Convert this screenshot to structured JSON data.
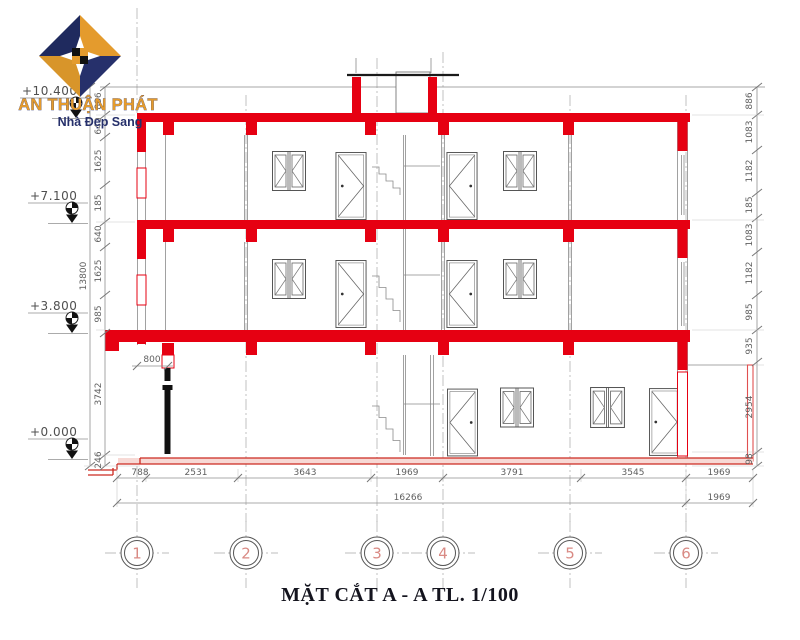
{
  "logo": {
    "company": "AN THUẬN PHÁT",
    "tagline": "Nhà Đẹp Sang"
  },
  "title": "MẶT CẮT A - A TL. 1/100",
  "elevations": {
    "roof": "+10.400",
    "floor3": "+7.100",
    "floor2": "+3.800",
    "ground": "+0.000"
  },
  "dimensions": {
    "left_overall": "13800",
    "left_chain": [
      "886",
      "640",
      "1625",
      "185",
      "640",
      "1625",
      "985",
      "3742",
      "246"
    ],
    "right_chain": [
      "886",
      "1083",
      "1182",
      "185",
      "1083",
      "1182",
      "985",
      "935",
      "2954",
      "98"
    ],
    "bottom_row1": [
      "788",
      "2531",
      "3643",
      "1969",
      "3791",
      "3545",
      "1969"
    ],
    "bottom_row2": [
      "16266",
      "1969"
    ],
    "door_width": "800"
  },
  "grid_bubbles": [
    "1",
    "2",
    "3",
    "4",
    "5",
    "6"
  ],
  "colors": {
    "structure_red": "#e60012",
    "ground_red": "#cc2a20",
    "line_gray": "#6e6e6e",
    "dim_gray": "#5f5f5f",
    "bubble_salmon": "#d98a84",
    "logo_gold": "#e49b2d",
    "logo_navy": "#26306b"
  }
}
